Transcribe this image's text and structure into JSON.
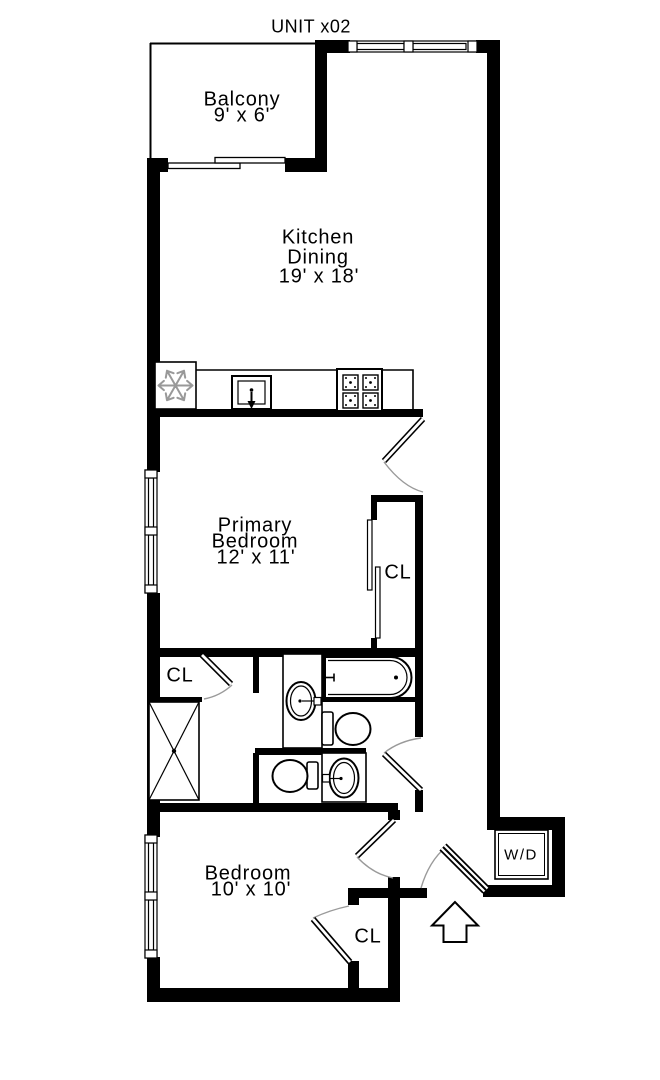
{
  "title": "UNIT x02",
  "rooms": {
    "balcony": {
      "name": "Balcony",
      "dims": "9' x 6'"
    },
    "kitchen": {
      "line1": "Kitchen",
      "line2": "Dining",
      "dims": "19' x 18'"
    },
    "primary_bedroom": {
      "line1": "Primary",
      "line2": "Bedroom",
      "dims": "12' x 11'"
    },
    "bedroom": {
      "name": "Bedroom",
      "dims": "10' x 10'"
    },
    "primary_closet": {
      "label": "CL"
    },
    "bathroom_closet": {
      "label": "CL"
    },
    "bedroom_closet": {
      "label": "CL"
    },
    "laundry": {
      "label": "W/D"
    }
  },
  "colors": {
    "wall": "#000000",
    "background": "#ffffff",
    "door_arc": "#9a9a9a",
    "fridge_icon": "#999999"
  }
}
